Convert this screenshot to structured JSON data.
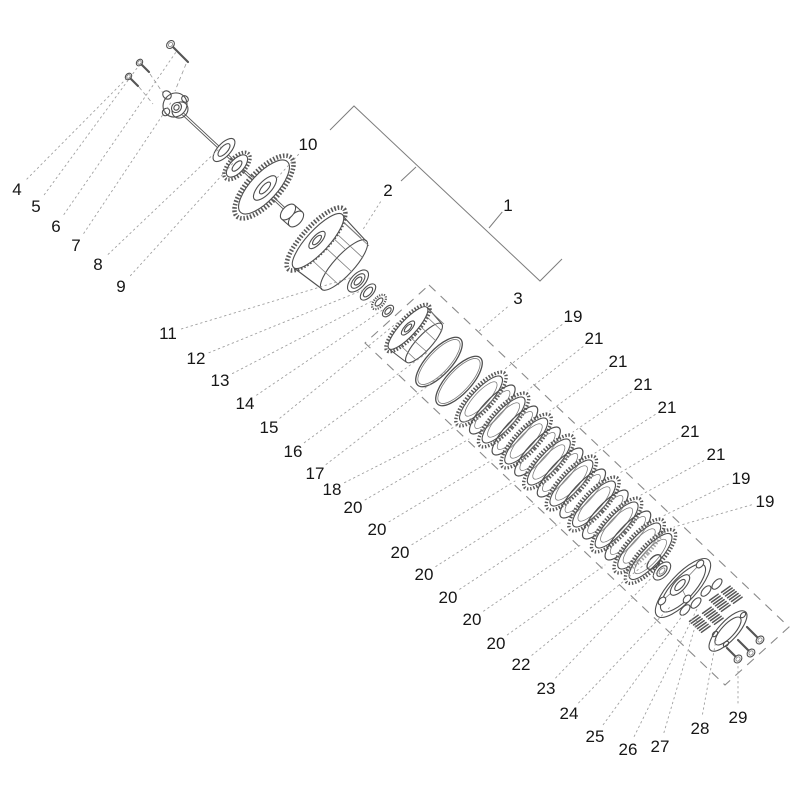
{
  "diagram": {
    "type": "exploded-parts-diagram",
    "background_color": "#ffffff",
    "part_stroke_color": "#4f4f4f",
    "leader_color": "#a0a0a0",
    "dashed_box_color": "#8a8a8a",
    "label_color": "#161616",
    "callouts": [
      {
        "n": "1",
        "x": 508,
        "y": 205,
        "tx": 489,
        "ty": 228,
        "solid": true
      },
      {
        "n": "2",
        "x": 388,
        "y": 190,
        "tx": 362,
        "ty": 231
      },
      {
        "n": "3",
        "x": 518,
        "y": 298,
        "tx": 478,
        "ty": 332
      },
      {
        "n": "4",
        "x": 17,
        "y": 189,
        "tx": 128,
        "ty": 77
      },
      {
        "n": "5",
        "x": 36,
        "y": 206,
        "tx": 140,
        "ty": 64
      },
      {
        "n": "6",
        "x": 56,
        "y": 226,
        "tx": 176,
        "ty": 52
      },
      {
        "n": "7",
        "x": 76,
        "y": 245,
        "tx": 172,
        "ty": 101
      },
      {
        "n": "8",
        "x": 98,
        "y": 264,
        "tx": 221,
        "ty": 147
      },
      {
        "n": "9",
        "x": 121,
        "y": 286,
        "tx": 234,
        "ty": 162
      },
      {
        "n": "10",
        "x": 308,
        "y": 144,
        "tx": 277,
        "ty": 178
      },
      {
        "n": "11",
        "x": 168,
        "y": 333,
        "tx": 350,
        "ty": 278
      },
      {
        "n": "12",
        "x": 196,
        "y": 358,
        "tx": 363,
        "ty": 290
      },
      {
        "n": "13",
        "x": 220,
        "y": 380,
        "tx": 374,
        "ty": 300
      },
      {
        "n": "14",
        "x": 245,
        "y": 403,
        "tx": 384,
        "ty": 309
      },
      {
        "n": "15",
        "x": 269,
        "y": 427,
        "tx": 398,
        "ty": 322
      },
      {
        "n": "16",
        "x": 293,
        "y": 451,
        "tx": 428,
        "ty": 352
      },
      {
        "n": "17",
        "x": 315,
        "y": 473,
        "tx": 447,
        "ty": 371
      },
      {
        "n": "18",
        "x": 332,
        "y": 489,
        "tx": 472,
        "ty": 418
      },
      {
        "n": "19",
        "x": 573,
        "y": 316,
        "tx": 505,
        "ty": 369
      },
      {
        "n": "21",
        "x": 594,
        "y": 338,
        "tx": 528,
        "ty": 390
      },
      {
        "n": "21",
        "x": 618,
        "y": 361,
        "tx": 550,
        "ty": 411
      },
      {
        "n": "21",
        "x": 643,
        "y": 384,
        "tx": 573,
        "ty": 432
      },
      {
        "n": "21",
        "x": 667,
        "y": 407,
        "tx": 595,
        "ty": 453
      },
      {
        "n": "21",
        "x": 690,
        "y": 431,
        "tx": 618,
        "ty": 474
      },
      {
        "n": "21",
        "x": 716,
        "y": 454,
        "tx": 641,
        "ty": 495
      },
      {
        "n": "19",
        "x": 741,
        "y": 478,
        "tx": 663,
        "ty": 516
      },
      {
        "n": "19",
        "x": 765,
        "y": 501,
        "tx": 674,
        "ty": 527
      },
      {
        "n": "20",
        "x": 353,
        "y": 507,
        "tx": 469,
        "ty": 439
      },
      {
        "n": "20",
        "x": 377,
        "y": 529,
        "tx": 492,
        "ty": 460
      },
      {
        "n": "20",
        "x": 400,
        "y": 552,
        "tx": 515,
        "ty": 481
      },
      {
        "n": "20",
        "x": 424,
        "y": 574,
        "tx": 537,
        "ty": 502
      },
      {
        "n": "20",
        "x": 448,
        "y": 597,
        "tx": 560,
        "ty": 523
      },
      {
        "n": "20",
        "x": 472,
        "y": 619,
        "tx": 582,
        "ty": 544
      },
      {
        "n": "20",
        "x": 496,
        "y": 643,
        "tx": 605,
        "ty": 565
      },
      {
        "n": "22",
        "x": 521,
        "y": 664,
        "tx": 650,
        "ty": 560
      },
      {
        "n": "23",
        "x": 546,
        "y": 688,
        "tx": 659,
        "ty": 570
      },
      {
        "n": "24",
        "x": 569,
        "y": 713,
        "tx": 671,
        "ty": 606
      },
      {
        "n": "25",
        "x": 595,
        "y": 736,
        "tx": 685,
        "ty": 612
      },
      {
        "n": "26",
        "x": 628,
        "y": 749,
        "tx": 698,
        "ty": 607
      },
      {
        "n": "27",
        "x": 660,
        "y": 746,
        "tx": 697,
        "ty": 620
      },
      {
        "n": "28",
        "x": 700,
        "y": 728,
        "tx": 716,
        "ty": 640
      },
      {
        "n": "29",
        "x": 738,
        "y": 717,
        "tx": 738,
        "ty": 661
      }
    ],
    "group_bracket_points": [
      [
        330,
        130
      ],
      [
        354,
        106
      ],
      [
        540,
        281
      ],
      [
        562,
        259
      ]
    ],
    "extra_solid_segments": [
      [
        401,
        181,
        416,
        167
      ]
    ],
    "kit_box_points": [
      [
        429,
        285
      ],
      [
        789,
        627
      ],
      [
        725,
        685
      ],
      [
        365,
        343
      ]
    ]
  }
}
